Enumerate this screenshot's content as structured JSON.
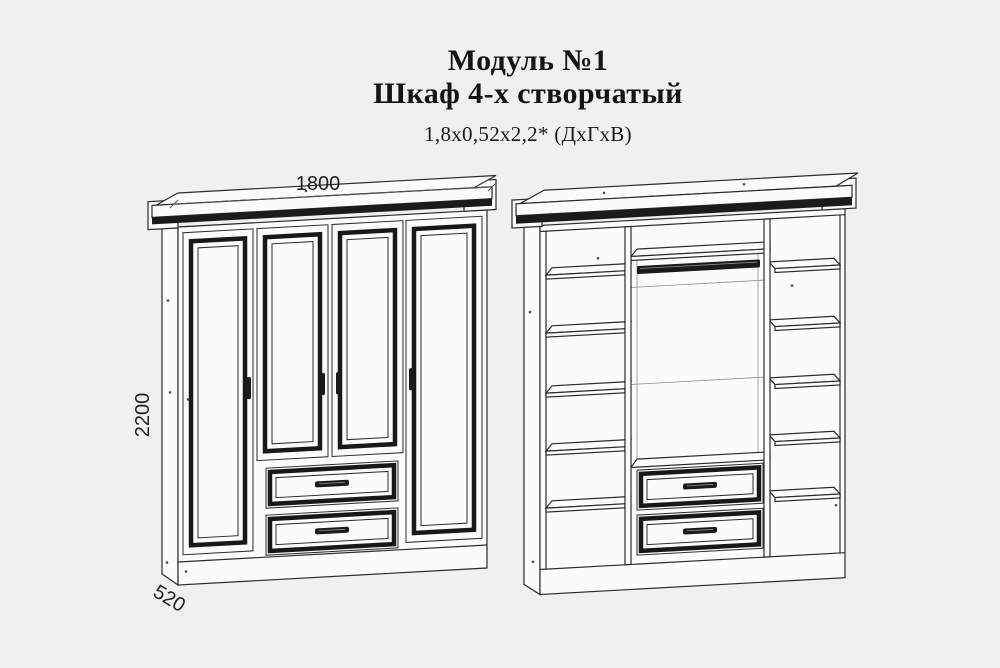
{
  "header": {
    "module_title": "Модуль №1",
    "product_title": "Шкаф 4-х створчатый",
    "size_note": "1,8х0,52х2,2* (ДхГхВ)"
  },
  "front_view": {
    "width_label": "1800",
    "height_label": "2200",
    "depth_label": "520"
  },
  "colors": {
    "background": "#f0f0f0",
    "line": "#2b2b2b",
    "dark_fill": "#1b1b1b",
    "panel": "#fbfbfb"
  }
}
